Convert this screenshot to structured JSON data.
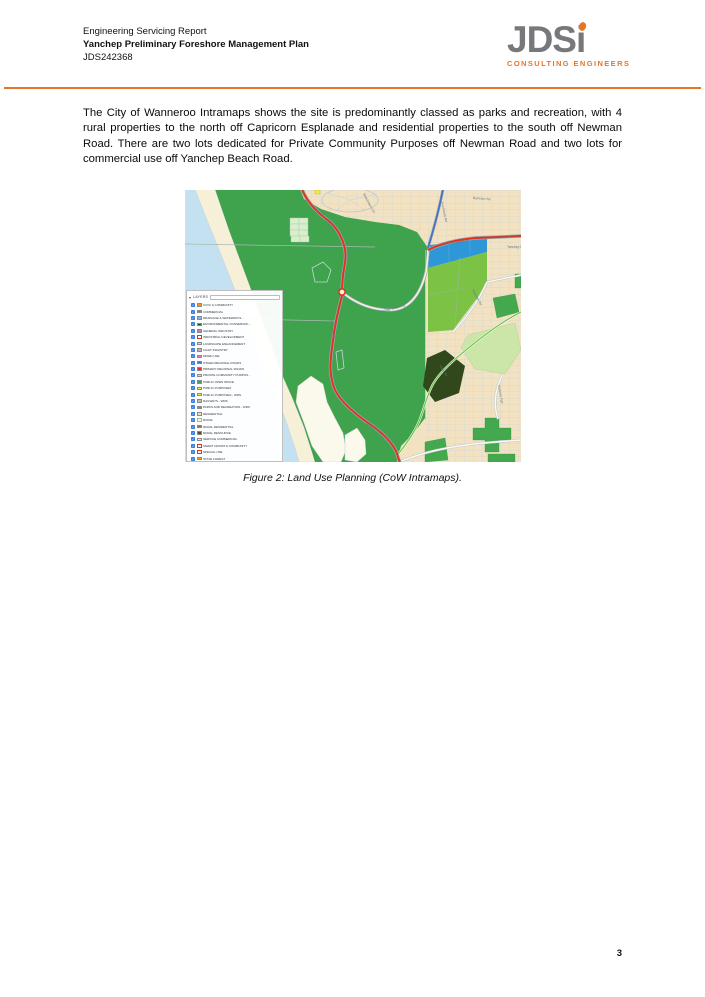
{
  "header": {
    "report_type": "Engineering Servicing Report",
    "title": "Yanchep Preliminary Foreshore Management Plan",
    "job_number": "JDS242368",
    "rule_color": "#E87525"
  },
  "logo": {
    "main": "JDS",
    "i": "i",
    "tagline": "CONSULTING ENGINEERS",
    "text_color": "#77787B",
    "accent_color": "#E87525"
  },
  "body": {
    "paragraph": "The City of Wanneroo Intramaps shows the site is predominantly classed as parks and recreation, with 4 rural properties to the north off Capricorn Esplanade and residential properties to the south off Newman Road. There are two lots dedicated for Private Community Purposes off Newman Road and two lots for commercial use off Yanchep Beach Road."
  },
  "figure": {
    "caption": "Figure 2: Land Use Planning (CoW Intramaps).",
    "map": {
      "colors": {
        "ocean": "#C3E1F1",
        "beach": "#F6F0D8",
        "parks_green": "#3FA24C",
        "lime_green": "#7CC244",
        "pale_green": "#CBE6A8",
        "dark_green": "#30481C",
        "commercial_blue": "#2E97D8",
        "residential_cream": "#F2E2C2",
        "primary_road_red": "#E2311C",
        "regional_road_blue": "#4472C4"
      },
      "legend": {
        "title": "LAYERS",
        "items": [
          {
            "label": "CIVIC & COMMUNITY",
            "color": "#F7941D"
          },
          {
            "label": "COMMERCIAL",
            "color": "#2E97D8"
          },
          {
            "label": "DRAINAGE & WATERWAYS...",
            "color": "#8DB4E2"
          },
          {
            "label": "ENVIRONMENTAL CONSERVATI...",
            "color": "#1F4F22"
          },
          {
            "label": "GENERAL INDUSTRY",
            "color": "#C17FB5"
          },
          {
            "label": "INDUSTRIAL DEVELOPMENT",
            "color": "#FFFFFF",
            "border": "#E0301E"
          },
          {
            "label": "LANDSCAPE ENHANCEMENT",
            "color": "#EDE94B"
          },
          {
            "label": "LIGHT INDUSTRY",
            "color": "#CBA6CF"
          },
          {
            "label": "MIXED USE",
            "color": "#E981B5"
          },
          {
            "label": "OTHER REGIONAL ROADS",
            "color": "#3A66C9"
          },
          {
            "label": "PRIMARY REGIONAL ROADS",
            "color": "#E0301E"
          },
          {
            "label": "PRIVATE COMMUNITY PURPOS...",
            "color": "#CDE8AD"
          },
          {
            "label": "PUBLIC OPEN SPACE",
            "color": "#3EA14B"
          },
          {
            "label": "PUBLIC PURPOSES",
            "color": "#F5F07A"
          },
          {
            "label": "PUBLIC PURPOSES - WRS",
            "color": "#F7ED4E"
          },
          {
            "label": "RAILWAYS - WRS",
            "color": "#BFBFBF"
          },
          {
            "label": "PARKS AND RECREATION - WRS",
            "color": "#4CAF50"
          },
          {
            "label": "RESIDENTIAL",
            "color": "#F2DFBD"
          },
          {
            "label": "RURAL",
            "color": "#F3F7E4",
            "border": "#9CC08C"
          },
          {
            "label": "RURAL RESIDENTIAL",
            "color": "#9C6B30"
          },
          {
            "label": "RURAL RESOURCE",
            "color": "#5C4726"
          },
          {
            "label": "SERVICE COMMERCIAL",
            "color": "#DCE6F1"
          },
          {
            "label": "SMART GROWTH COMMUNITY",
            "color": "#FFFFFF",
            "border": "#E0301E"
          },
          {
            "label": "SPECIAL USE",
            "color": "#FFFFFF",
            "border": "#E0301E"
          },
          {
            "label": "STATE FOREST",
            "color": "#F0A22E"
          }
        ]
      },
      "road_labels": [
        {
          "text": "Barteaux Ap",
          "x": 288,
          "y": 9,
          "rot": 3
        },
        {
          "text": "Beachhaven Dr",
          "x": 178,
          "y": 4,
          "rot": 62
        },
        {
          "text": "Two Rocks Rd",
          "x": 256,
          "y": 12,
          "rot": 78
        },
        {
          "text": "Yanchep Beach Rd",
          "x": 257,
          "y": 55,
          "rot": -7
        },
        {
          "text": "Yanchep Bea",
          "x": 315,
          "y": 48,
          "rot": -4
        },
        {
          "text": "Yanchep B",
          "x": 322,
          "y": 58,
          "rot": 0
        },
        {
          "text": "Two Rocks Rd",
          "x": 136,
          "y": 24,
          "rot": 55
        },
        {
          "text": "Two Rocks Rd",
          "x": 145,
          "y": 128,
          "rot": 82
        },
        {
          "text": "Yanchep Beach Rd",
          "x": 194,
          "y": 123,
          "rot": -14
        },
        {
          "text": "Newman Rd",
          "x": 287,
          "y": 100,
          "rot": 62
        },
        {
          "text": "Vidler Av",
          "x": 254,
          "y": 176,
          "rot": 55
        },
        {
          "text": "Hackney Pge",
          "x": 313,
          "y": 195,
          "rot": 80
        },
        {
          "text": "Brazier Rd",
          "x": 181,
          "y": 234,
          "rot": 32
        }
      ]
    }
  },
  "footer": {
    "page_number": "3"
  }
}
